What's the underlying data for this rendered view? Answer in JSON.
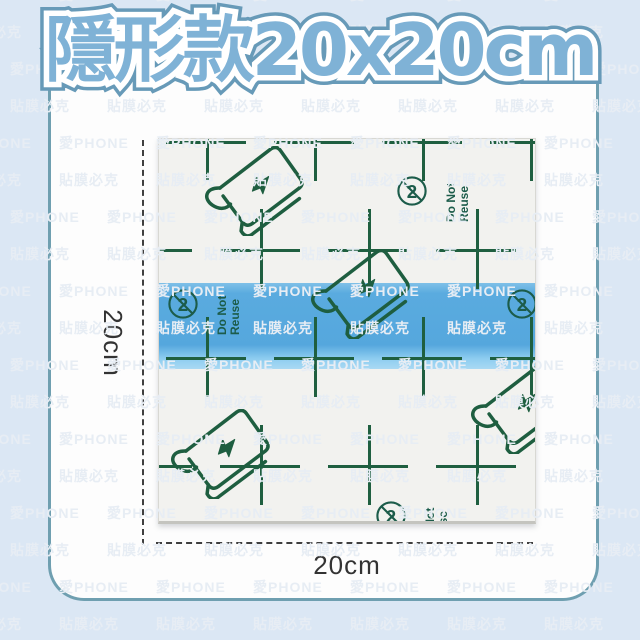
{
  "title": "隱形款20x20cm",
  "watermark": {
    "line1": "愛PHONE",
    "line2": "貼膜必克"
  },
  "dimension_labels": {
    "left": "20cm",
    "bottom": "20cm"
  },
  "film_markings": {
    "do_not_reuse_line1": "Do Not",
    "do_not_reuse_line2": "Reuse",
    "do_not_reuse_symbol": "2"
  },
  "colors": {
    "page_bg": "#dbe7f4",
    "card_border": "#6f9fb0",
    "title_fill": "#7fb2d6",
    "title_outline": "#679ab8",
    "grid_green": "#1f5f40",
    "strip_blue": "#58aadf"
  }
}
